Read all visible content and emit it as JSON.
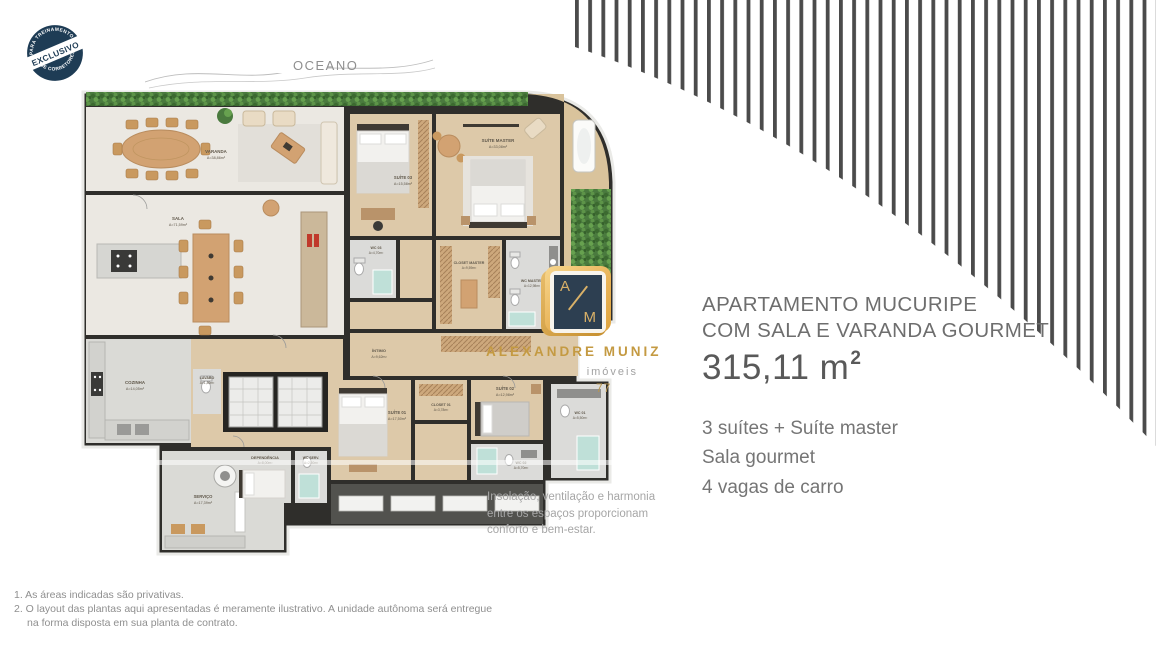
{
  "badge": {
    "top_arc": "PARA TREINAMENTO",
    "band": "EXCLUSIVO",
    "bottom_arc": "DE CORRETORES"
  },
  "ocean": {
    "label": "OCEANO"
  },
  "listing": {
    "title_line1": "APARTAMENTO MUCURIPE",
    "title_line2": "COM SALA E VARANDA GOURMET",
    "area_value": "315,11 m",
    "area_exponent": "2",
    "features": [
      "3 suítes + Suíte master",
      "Sala gourmet",
      "4 vagas de carro"
    ]
  },
  "caption": {
    "line1": "Insolação, ventilação e harmonia",
    "line2": "entre os espaços proporcionam",
    "line3": "conforto e bem-estar."
  },
  "watermark": {
    "monogram_a": "A",
    "monogram_m": "M",
    "brand": "ALEXANDRE MUNIZ",
    "sub": "imóveis",
    "number": "77"
  },
  "footnotes": {
    "line1": "1. As áreas indicadas são privativas.",
    "line2": "2. O layout das plantas aqui apresentadas é meramente ilustrativo. A unidade autônoma será entregue",
    "line3": "na forma disposta em sua planta de contrato."
  },
  "colors": {
    "accent_gold": "#c49a42",
    "navy": "#2d3f51",
    "wall": "#2f2e2b",
    "wood_floor": "#ddc9a9",
    "marble_floor": "#ebe8e2",
    "hedge_green": "#4a7a3e"
  },
  "floorplan": {
    "rooms": {
      "varanda": {
        "name": "VARANDA",
        "area": "A=38,86m²"
      },
      "sala": {
        "name": "SALA",
        "area": "A=71,59m²"
      },
      "cozinha": {
        "name": "COZINHA",
        "area": "A=14,05m²"
      },
      "lavabo": {
        "name": "LAVABO",
        "area": "A=1,80m²"
      },
      "suite_master": {
        "name": "SUÍTE MASTER",
        "area": "A=33,08m²"
      },
      "suite_01": {
        "name": "SUÍTE 01",
        "area": "A=17,50m²"
      },
      "suite_02": {
        "name": "SUÍTE 02",
        "area": "A=12,98m²"
      },
      "suite_03": {
        "name": "SUÍTE 03",
        "area": "A=15,58m²"
      },
      "closet_master": {
        "name": "CLOSET MASTER",
        "area": "A=9,59m²"
      },
      "closet_01": {
        "name": "CLOSET 01",
        "area": "A=3,78m²"
      },
      "wc_master": {
        "name": "WC MASTER",
        "area": "A=12,98m²"
      },
      "wc_01": {
        "name": "WC 01",
        "area": "A=5,50m²"
      },
      "wc_02": {
        "name": "WC 02",
        "area": "A=5,70m²"
      },
      "wc_03": {
        "name": "WC 03",
        "area": "A=4,70m²"
      },
      "servico": {
        "name": "SERVIÇO",
        "area": "A=17,39m²"
      },
      "dependencia": {
        "name": "DEPENDÊNCIA",
        "area": "A=8,00m²"
      },
      "wc_serv": {
        "name": "WC SERV.",
        "area": "A=2,50m²"
      },
      "intimo": {
        "name": "ÍNTIMO",
        "area": "A=9,62m²"
      }
    }
  }
}
